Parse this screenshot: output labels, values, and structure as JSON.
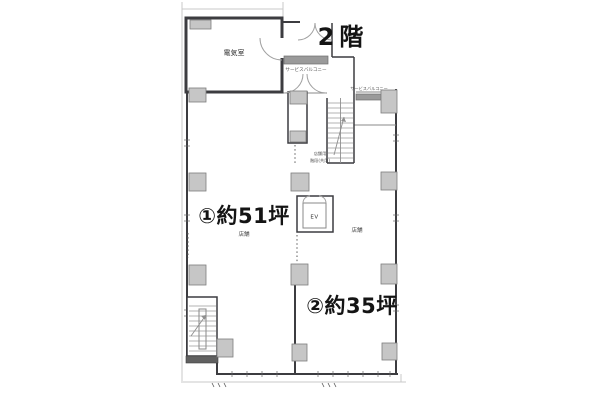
{
  "drawing": {
    "floor_title": "2階",
    "areas": [
      {
        "label": "①約51坪",
        "sub": "店舗"
      },
      {
        "label": "②約35坪",
        "sub": "店舗"
      }
    ],
    "rooms": {
      "electric_room": "電気室",
      "elevator": "EV",
      "stair_label_line1": "店舗用",
      "stair_label_line2": "階段(共用)",
      "service_balcony_top": "サービスバルコニー",
      "service_balcony_right": "サービスバルコニー"
    }
  },
  "colors": {
    "wall": "#3c3c40",
    "wall-light": "#8a8a8a",
    "column-fill": "#c6c6c6",
    "column-stroke": "#7d7d7d",
    "hatch-fill": "#9a9a9a",
    "faint": "#c9c9c9",
    "label-dark": "#141414",
    "label-gray": "#4a4a4a",
    "bg": "#ffffff"
  }
}
